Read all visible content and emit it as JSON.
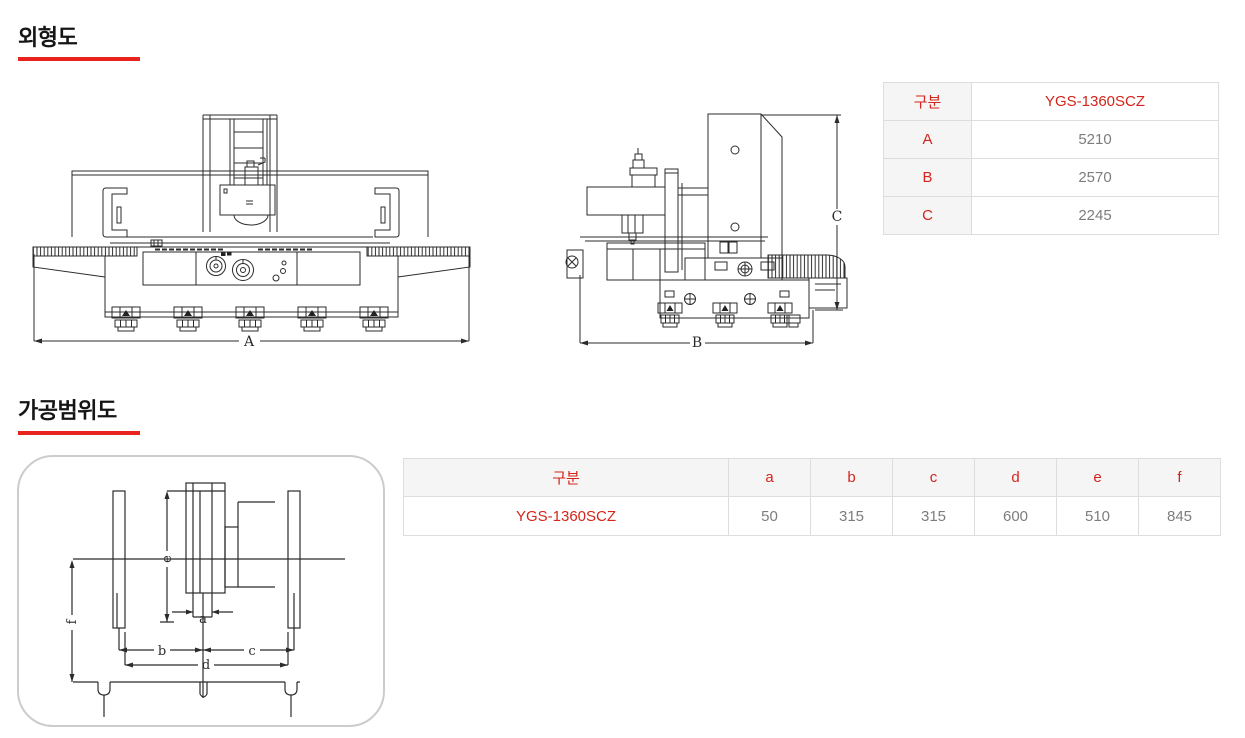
{
  "colors": {
    "underline_red": "#e8231d",
    "accent_red": "#d3251c",
    "value_gray": "#7d7d7d",
    "line_dark": "#2b2b2b",
    "table_border": "#dddddd",
    "key_bg": "#f5f5f5"
  },
  "sections": {
    "outline": {
      "heading": "외형도"
    },
    "range": {
      "heading": "가공범위도"
    }
  },
  "outline_table": {
    "col_header": "구분",
    "model": "YGS-1360SCZ",
    "rows": [
      {
        "label": "A",
        "value": "5210"
      },
      {
        "label": "B",
        "value": "2570"
      },
      {
        "label": "C",
        "value": "2245"
      }
    ]
  },
  "range_table": {
    "headers": [
      "구분",
      "a",
      "b",
      "c",
      "d",
      "e",
      "f"
    ],
    "row_label": "YGS-1360SCZ",
    "values": [
      "50",
      "315",
      "315",
      "600",
      "510",
      "845"
    ]
  },
  "drawings": {
    "front": {
      "dim_width": "A"
    },
    "side": {
      "dim_width": "B",
      "dim_height": "C"
    },
    "range": {
      "a": "a",
      "b": "b",
      "c": "c",
      "d": "d",
      "e": "e",
      "f": "f"
    }
  }
}
